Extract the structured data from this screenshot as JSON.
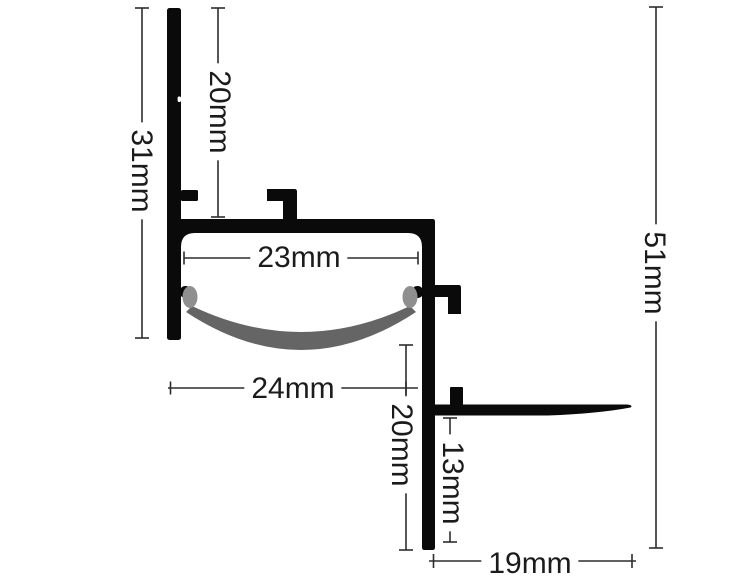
{
  "figure": {
    "type": "technical-drawing",
    "subject": "LED aluminium profile cross-section with diffuser lens",
    "unit": "mm",
    "colors": {
      "bg": "#ffffff",
      "profile": "#0a0a0a",
      "lens": "#656565",
      "lens_clip": "#8f8f8f",
      "line": "#2d2d2d",
      "text": "#1b1b1b"
    },
    "dimensions": {
      "top_height": {
        "label": "20mm",
        "value": 20,
        "unit": "mm",
        "orientation": "vertical"
      },
      "left_height": {
        "label": "31mm",
        "value": 31,
        "unit": "mm",
        "orientation": "vertical"
      },
      "inner_width": {
        "label": "23mm",
        "value": 23,
        "unit": "mm",
        "orientation": "horizontal"
      },
      "outer_width": {
        "label": "24mm",
        "value": 24,
        "unit": "mm",
        "orientation": "horizontal"
      },
      "lower_height": {
        "label": "20mm",
        "value": 20,
        "unit": "mm",
        "orientation": "vertical"
      },
      "flange_drop": {
        "label": "13mm",
        "value": 13,
        "unit": "mm",
        "orientation": "vertical"
      },
      "flange_width": {
        "label": "19mm",
        "value": 19,
        "unit": "mm",
        "orientation": "horizontal"
      },
      "total_height": {
        "label": "51mm",
        "value": 51,
        "unit": "mm",
        "orientation": "vertical"
      }
    }
  }
}
